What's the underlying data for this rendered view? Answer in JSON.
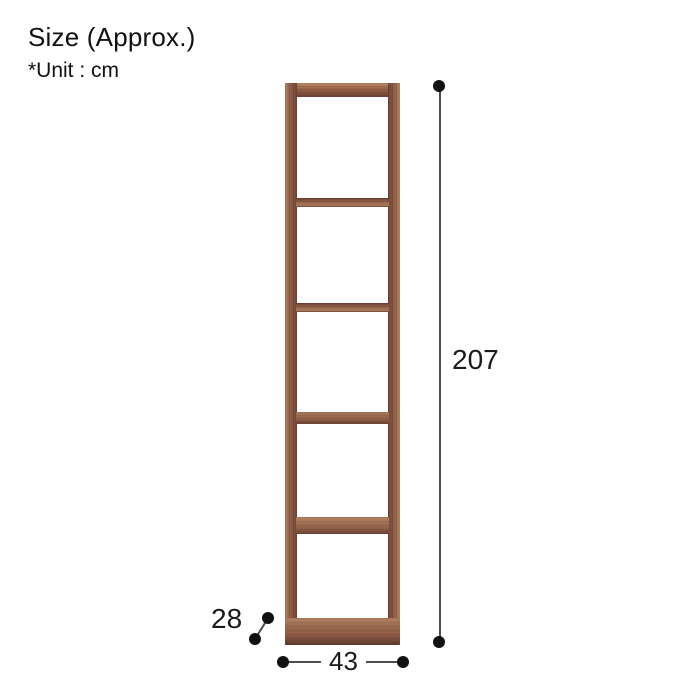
{
  "header": {
    "title": "Size (Approx.)",
    "unit_note": "*Unit : cm"
  },
  "illustration": {
    "kind": "open-shelf-rack",
    "compartments": 5,
    "finish": "walnut-brown"
  },
  "dimensions": {
    "height_cm": "207",
    "width_cm": "43",
    "depth_cm": "28"
  },
  "colors": {
    "background": "#ffffff",
    "text": "#111111",
    "dimension_text": "#1a1a1a",
    "dimension_line": "#4d4d4d",
    "dimension_dot": "#111111",
    "wood_light": "#b08262",
    "wood_base": "#8e5c46",
    "wood_dark": "#6b4132",
    "wood_deep": "#573428"
  }
}
